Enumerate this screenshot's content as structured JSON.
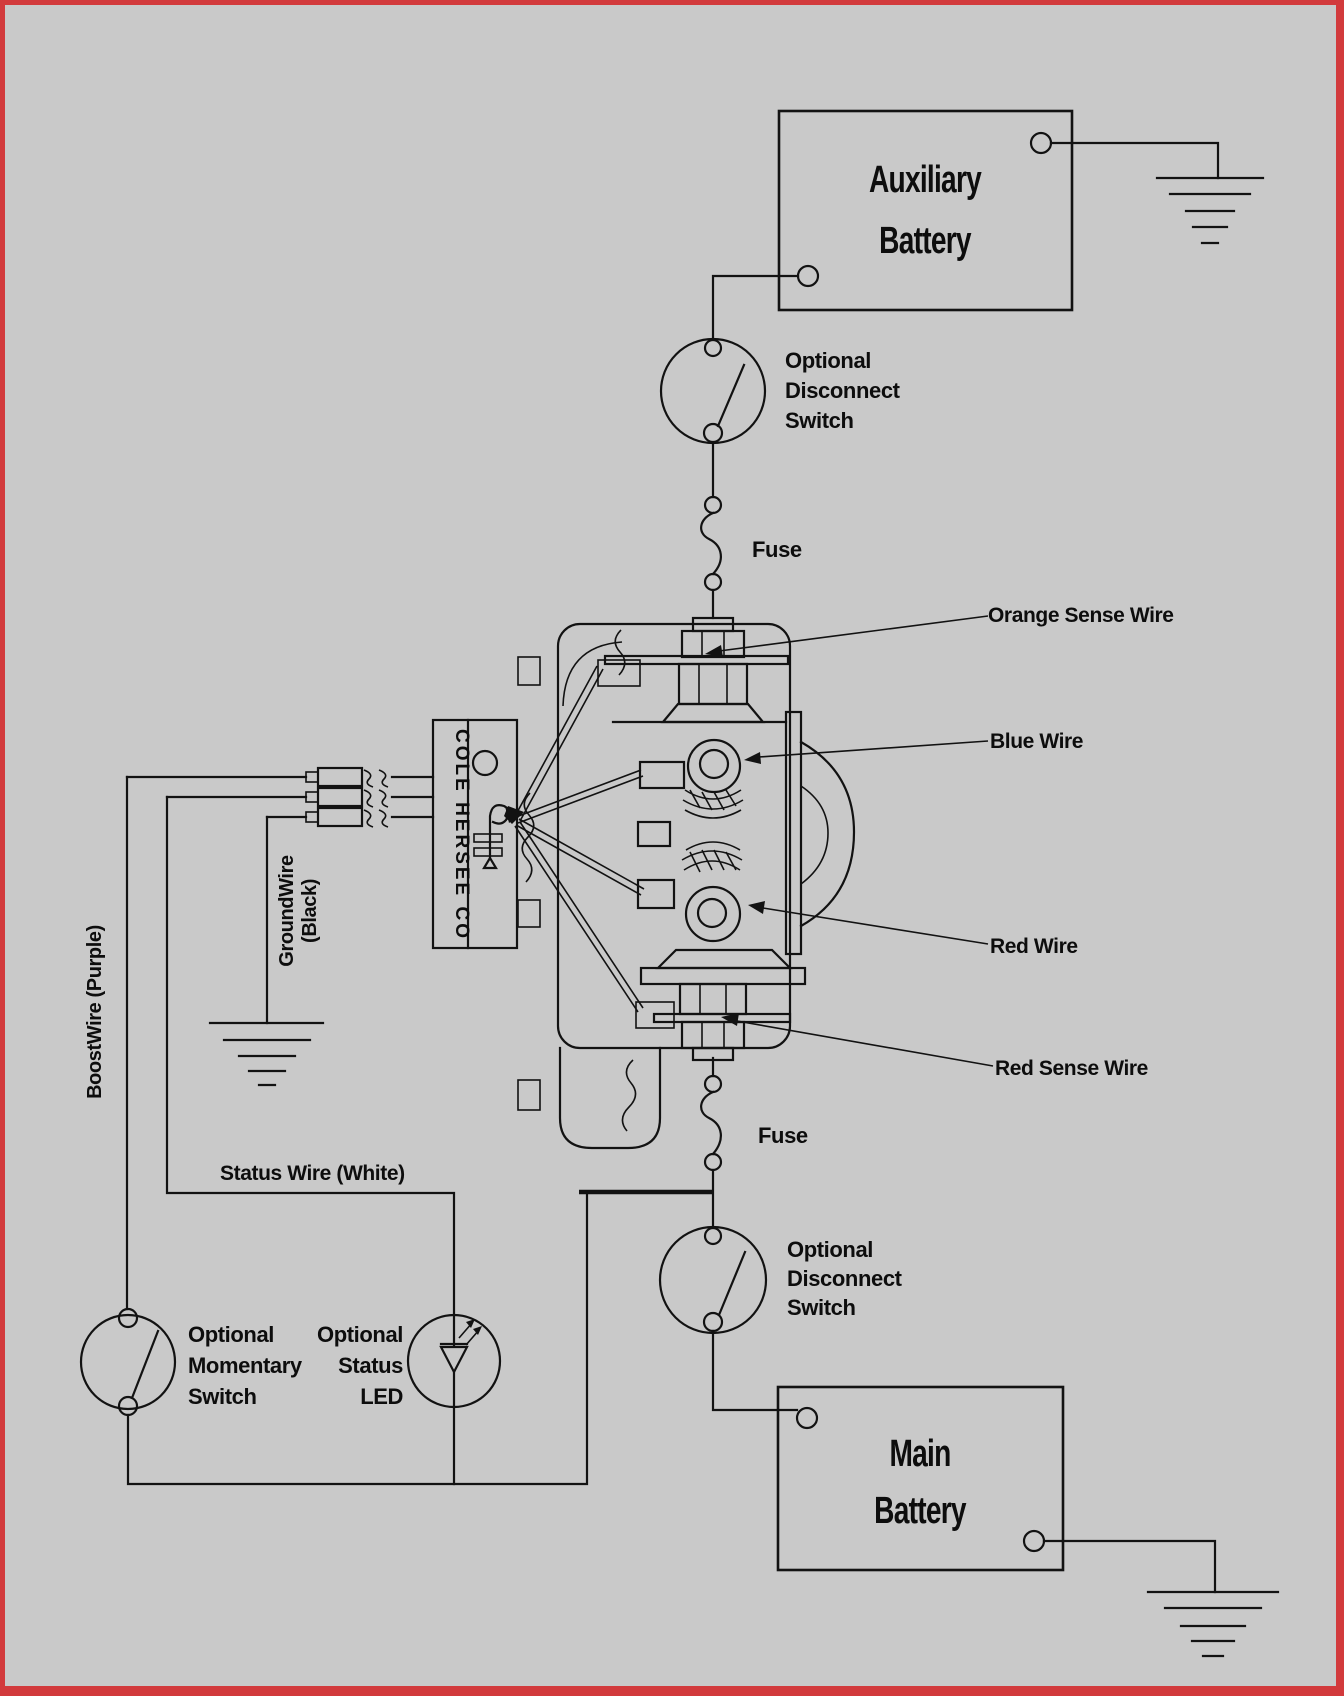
{
  "colors": {
    "background": "#c9c9c9",
    "border": "#d23a3c",
    "line": "#121212"
  },
  "auxiliary_battery": {
    "label_line1": "Auxiliary",
    "label_line2": "Battery"
  },
  "main_battery": {
    "label_line1": "Main",
    "label_line2": "Battery"
  },
  "relay": {
    "brand_text": "COLE HERSEE CO"
  },
  "switches": {
    "disconnect_upper": {
      "line1": "Optional",
      "line2": "Disconnect",
      "line3": "Switch"
    },
    "disconnect_lower": {
      "line1": "Optional",
      "line2": "Disconnect",
      "line3": "Switch"
    },
    "momentary": {
      "line1": "Optional",
      "line2": "Momentary",
      "line3": "Switch"
    },
    "status_led": {
      "line1": "Optional",
      "line2": "Status",
      "line3": "LED"
    }
  },
  "fuses": {
    "upper": "Fuse",
    "lower": "Fuse"
  },
  "wire_labels": {
    "orange_sense": "Orange Sense Wire",
    "blue": "Blue Wire",
    "red": "Red Wire",
    "red_sense": "Red Sense Wire",
    "boost": "BoostWire (Purple)",
    "ground_line1": "GroundWire",
    "ground_line2": "(Black)",
    "status": "Status Wire (White)"
  }
}
